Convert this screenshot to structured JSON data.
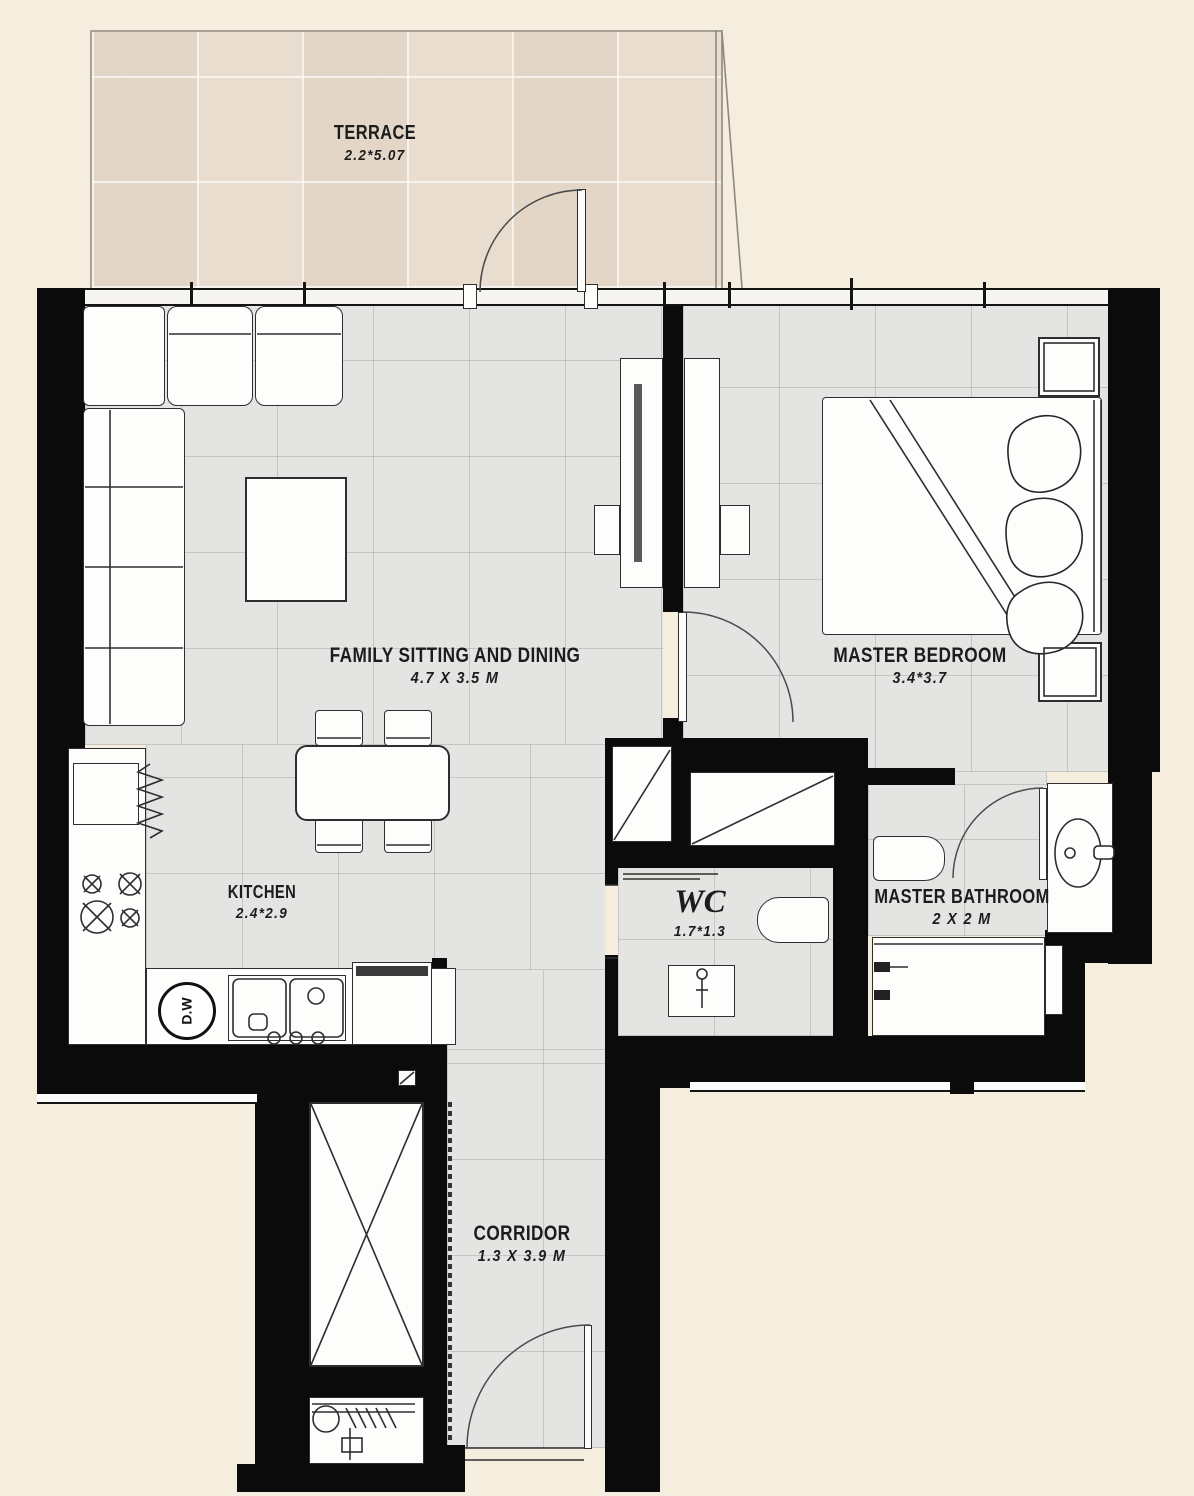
{
  "rooms": [
    {
      "key": "terrace",
      "name": "TERRACE",
      "dims": "2.2*5.07"
    },
    {
      "key": "family_sitting",
      "name": "FAMILY SITTING AND DINING",
      "dims": "4.7 X 3.5 M"
    },
    {
      "key": "master_bedroom",
      "name": "MASTER BEDROOM",
      "dims": "3.4*3.7"
    },
    {
      "key": "kitchen",
      "name": "KITCHEN",
      "dims": "2.4*2.9"
    },
    {
      "key": "wc",
      "name": "WC",
      "dims": "1.7*1.3"
    },
    {
      "key": "master_bathroom",
      "name": "MASTER BATHROOM",
      "dims": "2 X 2 M"
    },
    {
      "key": "corridor",
      "name": "CORRIDOR",
      "dims": "1.3 X 3.9 M"
    }
  ],
  "appliances": {
    "dishwasher_label": "D.W"
  },
  "colors": {
    "background": "#f5edde",
    "floor": "#e4e4e2",
    "terrace": "#e9ddcf",
    "wall": "#0b0b0b"
  }
}
